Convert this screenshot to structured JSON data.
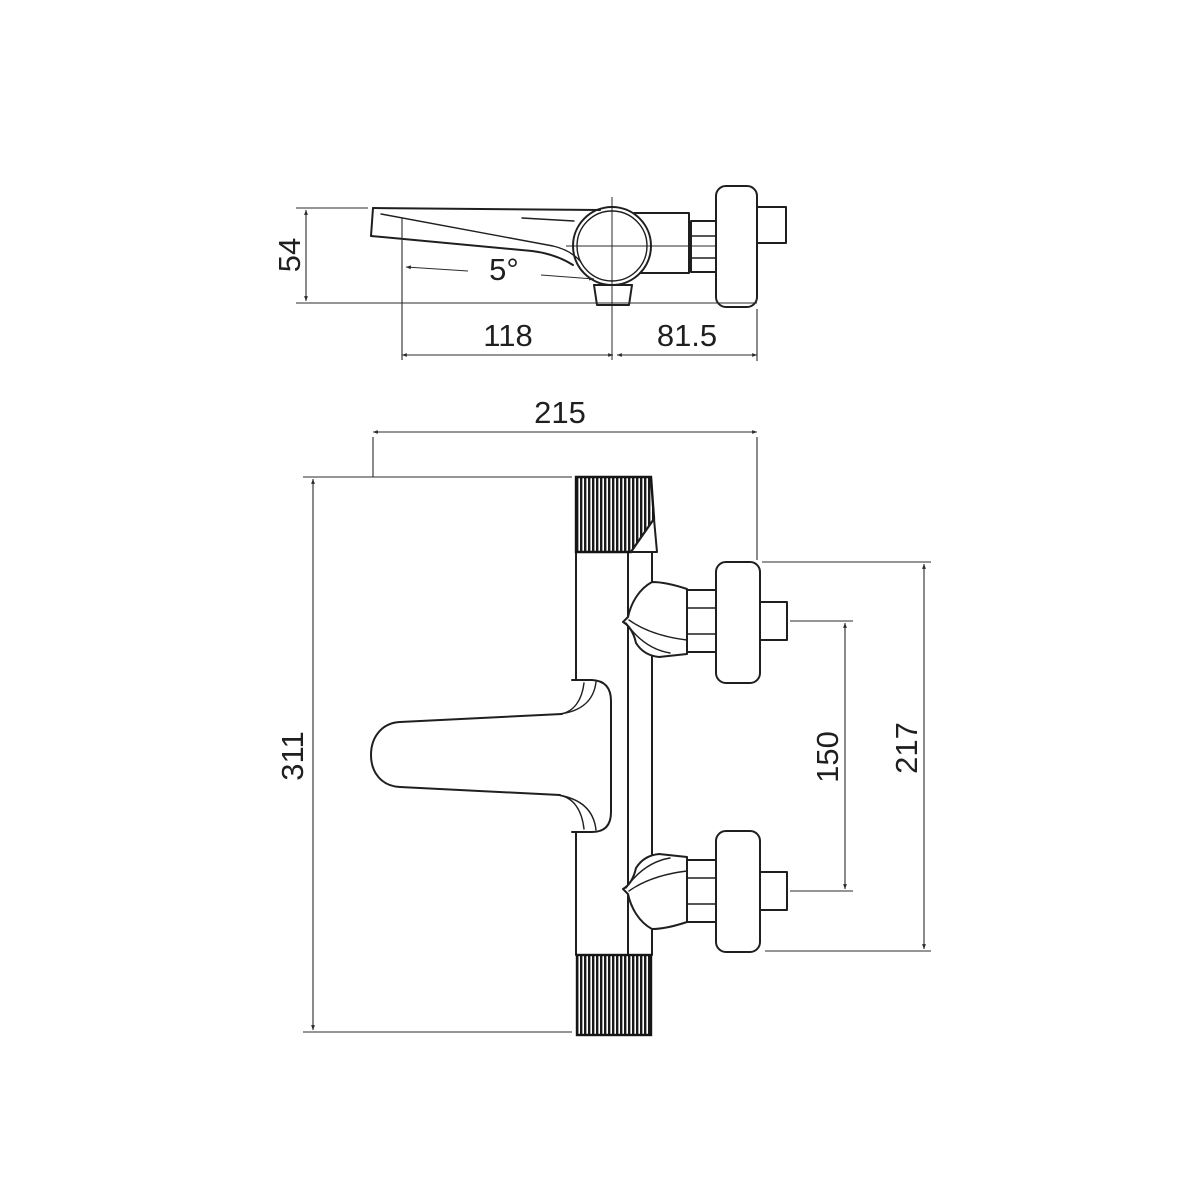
{
  "drawing": {
    "type": "technical-drawing",
    "subject": "wall-mounted bath mixer tap, two orthographic views with dimensions",
    "units": "mm",
    "colors": {
      "background": "#ffffff",
      "object_line": "#1f1f1f",
      "dimension_line": "#2b2b2b",
      "knurl_fill": "#151515"
    },
    "dimensions": {
      "side_view": {
        "height_mm": "54",
        "spout_angle": "5°",
        "spout_reach_mm": "118",
        "outlet_to_wall_mm": "81.5"
      },
      "front_view": {
        "overall_width_mm": "215",
        "overall_height_mm": "311",
        "connection_centers_mm": "150",
        "flange_span_mm": "217"
      }
    }
  }
}
